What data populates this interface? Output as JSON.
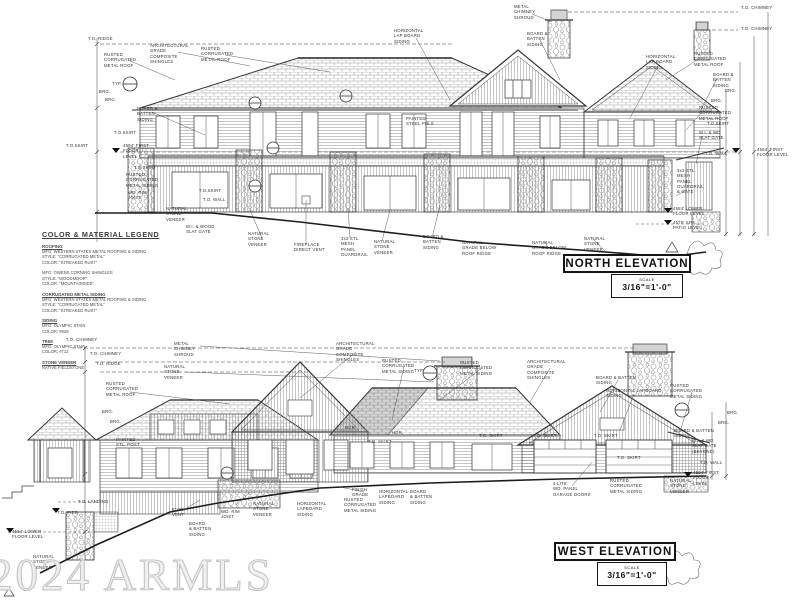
{
  "watermark": "2024 ARMLS",
  "legend": {
    "title": "COLOR & MATERIAL LEGEND",
    "sections": [
      {
        "heading": "ROOFING",
        "body": "MFG: WESTERN STATES METAL ROOFING & SIDING\nSTYLE: \"CORRUGATED METAL\"\nCOLOR: \"STREAKED RUST\""
      },
      {
        "heading": "",
        "body": "MFG: OWENS CORNING SHINGLES\nSTYLE: \"WOODMOOR\"\nCOLOR: \"MOUNTAINSIDE\""
      },
      {
        "heading": "CORRUGATED METAL SIDING",
        "body": "MFG: WESTERN STATES METAL ROOFING & SIDING\nSTYLE: \"CORRUGATED METAL\"\nCOLOR: \"STREAKED RUST\""
      },
      {
        "heading": "SIDING",
        "body": "MFG: OLYMPIC STAIN\nCOLOR: #929"
      },
      {
        "heading": "TRIM",
        "body": "MFG: OLYMPIC STAIN\nCOLOR: #712"
      },
      {
        "heading": "STONE VENEER",
        "body": "NATIVE FIELDSTONE"
      }
    ]
  },
  "north": {
    "title": "NORTH ELEVATION",
    "scale_label": "SCALE",
    "scale": "3/16\"=1'-0\"",
    "labels": [
      {
        "t": "T.O. RIDGE",
        "x": 88,
        "y": 36
      },
      {
        "t": "RUSTED\nCORRUGATED\nMETAL ROOF",
        "x": 104,
        "y": 52
      },
      {
        "t": "ARCHITECTURAL\nGRADE\nCOMPOSITE\nSHINGLES",
        "x": 150,
        "y": 43
      },
      {
        "t": "RUSTED\nCORRUGATED\nMETAL ROOF",
        "x": 201,
        "y": 46
      },
      {
        "t": "TYP.",
        "x": 112,
        "y": 81
      },
      {
        "t": "BRG.",
        "x": 99,
        "y": 89
      },
      {
        "t": "BRG.",
        "x": 105,
        "y": 97
      },
      {
        "t": "BOARD &\nBATTEN\nSIDING",
        "x": 137,
        "y": 106
      },
      {
        "t": "T.O.SKIRT",
        "x": 66,
        "y": 143
      },
      {
        "t": "4594' FIRST\nFLOOR\nLEVEL",
        "x": 123,
        "y": 143
      },
      {
        "t": "T.O.SKIRT",
        "x": 114,
        "y": 130
      },
      {
        "t": "T.O.SKIRT",
        "x": 134,
        "y": 165
      },
      {
        "t": "RUSTED\nCORRUGATED\nMETAL SIDING",
        "x": 126,
        "y": 172
      },
      {
        "t": "WD. RIM\nJOIST",
        "x": 128,
        "y": 190
      },
      {
        "t": "NATURAL\nSTONE\nVENEER",
        "x": 166,
        "y": 206
      },
      {
        "t": "W.I. & WOOD\nSLAT GATE",
        "x": 186,
        "y": 224
      },
      {
        "t": "T.O.SKIRT",
        "x": 199,
        "y": 188
      },
      {
        "t": "T.O. WALL",
        "x": 203,
        "y": 197
      },
      {
        "t": "HORIZONTAL\nLAP BOARD\nSIDING",
        "x": 394,
        "y": 28
      },
      {
        "t": "METAL\nCHIMNEY\nSHROUD",
        "x": 514,
        "y": 4
      },
      {
        "t": "BOARD &\nBATTEN\nSIDING",
        "x": 527,
        "y": 31
      },
      {
        "t": "T.O. CHIMNEY",
        "x": 741,
        "y": 5
      },
      {
        "t": "T.O. CHIMNEY",
        "x": 741,
        "y": 26
      },
      {
        "t": "PAINTED\nSTEEL PNLS",
        "x": 406,
        "y": 116
      },
      {
        "t": "NATURAL\nSTONE\nVENEER",
        "x": 248,
        "y": 231
      },
      {
        "t": "FIREPLACE\nDIRECT VENT",
        "x": 294,
        "y": 242
      },
      {
        "t": "3x3 STL.\nMESH\nPANEL\nGUARDRAIL",
        "x": 341,
        "y": 236
      },
      {
        "t": "NATURAL\nSTONE\nVENEER",
        "x": 374,
        "y": 239
      },
      {
        "t": "BOARD &\nBATTEN\nSIDING",
        "x": 423,
        "y": 234
      },
      {
        "t": "NATURAL\nGRADE BELOW\nROOF RIDGE",
        "x": 462,
        "y": 240
      },
      {
        "t": "NATURAL\nGRADE BELOW\nROOF RIDGE",
        "x": 532,
        "y": 240
      },
      {
        "t": "NATURAL\nSTONE\nVENEER",
        "x": 584,
        "y": 236
      },
      {
        "t": "3x3 STL.\nMESH\nPANEL\nGUARDRAIL\n& GATE",
        "x": 677,
        "y": 168
      },
      {
        "t": "4584' LOWER\nFLOOR LEVEL",
        "x": 673,
        "y": 206
      },
      {
        "t": "4578' SPA\nPATIO LEVEL",
        "x": 673,
        "y": 220
      },
      {
        "t": "HORIZONTAL\nLAP BOARD\nSIDING",
        "x": 646,
        "y": 54
      },
      {
        "t": "RUSTED\nCORRUGATED\nMETAL ROOF",
        "x": 694,
        "y": 51
      },
      {
        "t": "BOARD &\nBATTEN\nSIDING",
        "x": 713,
        "y": 72
      },
      {
        "t": "BRG.",
        "x": 725,
        "y": 88
      },
      {
        "t": "BRG.",
        "x": 711,
        "y": 98
      },
      {
        "t": "RUSTED\nCORRUGATED\nMETAL ROOF",
        "x": 699,
        "y": 105
      },
      {
        "t": "T.O.SKIRT",
        "x": 707,
        "y": 121
      },
      {
        "t": "W.I. & WD\nSLAT GATE",
        "x": 699,
        "y": 130
      },
      {
        "t": "T.O. WALL",
        "x": 705,
        "y": 151
      },
      {
        "t": "4594' FIRST\nFLOOR LEVEL",
        "x": 757,
        "y": 147
      }
    ]
  },
  "west": {
    "title": "WEST ELEVATION",
    "scale_label": "SCALE",
    "scale": "3/16\"=1'-0\"",
    "labels": [
      {
        "t": "T.O. CHIMNEY",
        "x": 66,
        "y": 337
      },
      {
        "t": "T.O. CHIMNEY",
        "x": 90,
        "y": 351
      },
      {
        "t": "T.O. RIDGE",
        "x": 96,
        "y": 361
      },
      {
        "t": "METAL\nCHIMNEY\nSHROUD",
        "x": 174,
        "y": 341
      },
      {
        "t": "NATURAL\nSTONE\nVENEER",
        "x": 164,
        "y": 364
      },
      {
        "t": "RUSTED\nCORRUGATED\nMETAL ROOF",
        "x": 106,
        "y": 381
      },
      {
        "t": "BRG.",
        "x": 102,
        "y": 409
      },
      {
        "t": "BRG.",
        "x": 110,
        "y": 419
      },
      {
        "t": "PAINTED\nSTL. POST",
        "x": 116,
        "y": 437
      },
      {
        "t": "ARCHITECTURAL\nGRADE\nCOMPOSITE\nSHINGLES",
        "x": 336,
        "y": 341
      },
      {
        "t": "RUSTED\nCORRUGATED\nMETAL SIDING",
        "x": 382,
        "y": 358
      },
      {
        "t": "TYP.",
        "x": 414,
        "y": 368
      },
      {
        "t": "RUSTED\nCORRUGATED\nMETAL SIDING",
        "x": 460,
        "y": 360
      },
      {
        "t": "ARCHITECTURAL\nGRADE\nCOMPOSITE\nSHINGLES",
        "x": 527,
        "y": 359
      },
      {
        "t": "BOARD & BATTEN\nSIDING",
        "x": 596,
        "y": 375
      },
      {
        "t": "HORIZONTAL LAPBOARD\nSIDING",
        "x": 606,
        "y": 388
      },
      {
        "t": "RUSTED\nCORRUGATED\nMETAL SIDING",
        "x": 670,
        "y": 383
      },
      {
        "t": "BOARD & BATTEN\nSIDING",
        "x": 674,
        "y": 428
      },
      {
        "t": "W.I. & WD\nSLAT GATE\n(BEYOND)",
        "x": 692,
        "y": 438
      },
      {
        "t": "BRG.",
        "x": 727,
        "y": 410
      },
      {
        "t": "BRG.",
        "x": 718,
        "y": 420
      },
      {
        "t": "T.O. WALL",
        "x": 700,
        "y": 460
      },
      {
        "t": "4594' FIRST\nFLOOR\nLEVEL",
        "x": 693,
        "y": 470
      },
      {
        "t": "HDR.",
        "x": 345,
        "y": 425
      },
      {
        "t": "HDR.",
        "x": 392,
        "y": 430
      },
      {
        "t": "T.O. SKIRT",
        "x": 368,
        "y": 439
      },
      {
        "t": "T.O. SKIRT",
        "x": 479,
        "y": 433
      },
      {
        "t": "T.O. SKIRT",
        "x": 533,
        "y": 433
      },
      {
        "t": "T.O. SKIRT",
        "x": 594,
        "y": 433
      },
      {
        "t": "T.O. SKIRT",
        "x": 617,
        "y": 455
      },
      {
        "t": "RUSTED\nCORRUGATED\nMETAL SIDING",
        "x": 610,
        "y": 478
      },
      {
        "t": "NATURAL\nSTONE\nVENEER",
        "x": 670,
        "y": 478
      },
      {
        "t": "4-LITE\nWD. PANEL\nGARAGE DOORS",
        "x": 553,
        "y": 481
      },
      {
        "t": "FINISH\nGRADE",
        "x": 352,
        "y": 487
      },
      {
        "t": "HORIZONTAL\nLAPBOARD\nSIDING",
        "x": 379,
        "y": 489
      },
      {
        "t": "BOARD\n& BATTEN\nSIDING",
        "x": 410,
        "y": 489
      },
      {
        "t": "RUSTED\nCORRUGATED\nMETAL SIDING",
        "x": 344,
        "y": 497
      },
      {
        "t": "HORIZONTAL\nLAPBOARD\nSIDING",
        "x": 297,
        "y": 501
      },
      {
        "t": "NATURAL\nSTONE\nVENEER",
        "x": 253,
        "y": 501
      },
      {
        "t": "WD. RIM\nJOIST",
        "x": 221,
        "y": 509
      },
      {
        "t": "8\"x8\"\nVENT",
        "x": 172,
        "y": 507
      },
      {
        "t": "BOARD\n& BATTEN\nSIDING",
        "x": 189,
        "y": 521
      },
      {
        "t": "T.O. LANDING",
        "x": 78,
        "y": 499
      },
      {
        "t": "T.O. PIER",
        "x": 57,
        "y": 510
      },
      {
        "t": "4584' LOWER\nFLOOR LEVEL",
        "x": 12,
        "y": 529
      },
      {
        "t": "NATURAL\nSTONE\nVENEER",
        "x": 33,
        "y": 554
      }
    ]
  }
}
